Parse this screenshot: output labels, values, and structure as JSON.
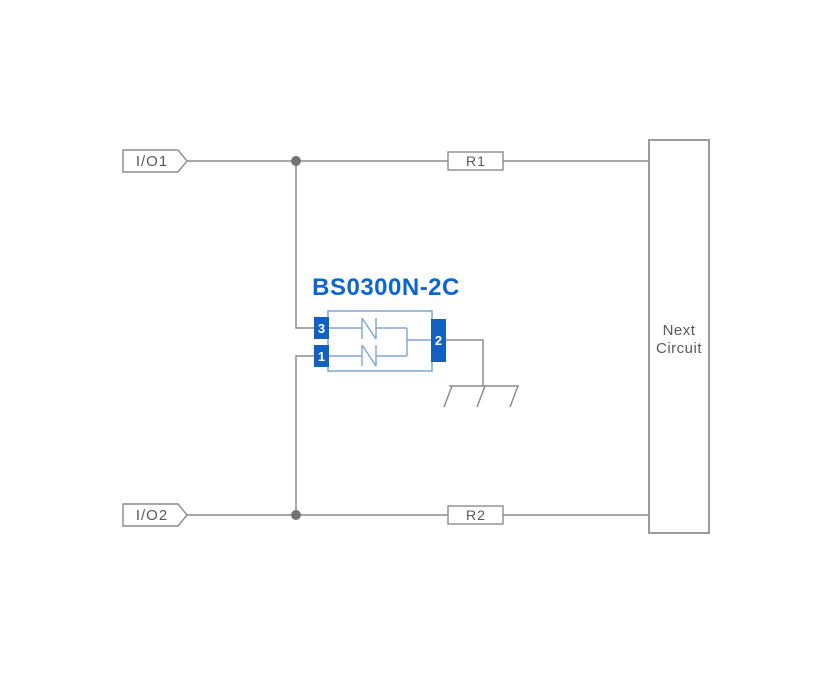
{
  "diagram": {
    "title": "BS0300N-2C",
    "io1_label": "I/O1",
    "io2_label": "I/O2",
    "r1_label": "R1",
    "r2_label": "R2",
    "next_circuit_line1": "Next",
    "next_circuit_line2": "Circuit",
    "pin1": "1",
    "pin2": "2",
    "pin3": "3",
    "colors": {
      "wire_gray": "#8c8c8c",
      "junction_gray": "#737373",
      "label_gray": "#595959",
      "pin_blue": "#1261c0",
      "outline_blue": "#7ca6d8",
      "title_blue": "#0d66cf",
      "background": "#ffffff"
    }
  }
}
